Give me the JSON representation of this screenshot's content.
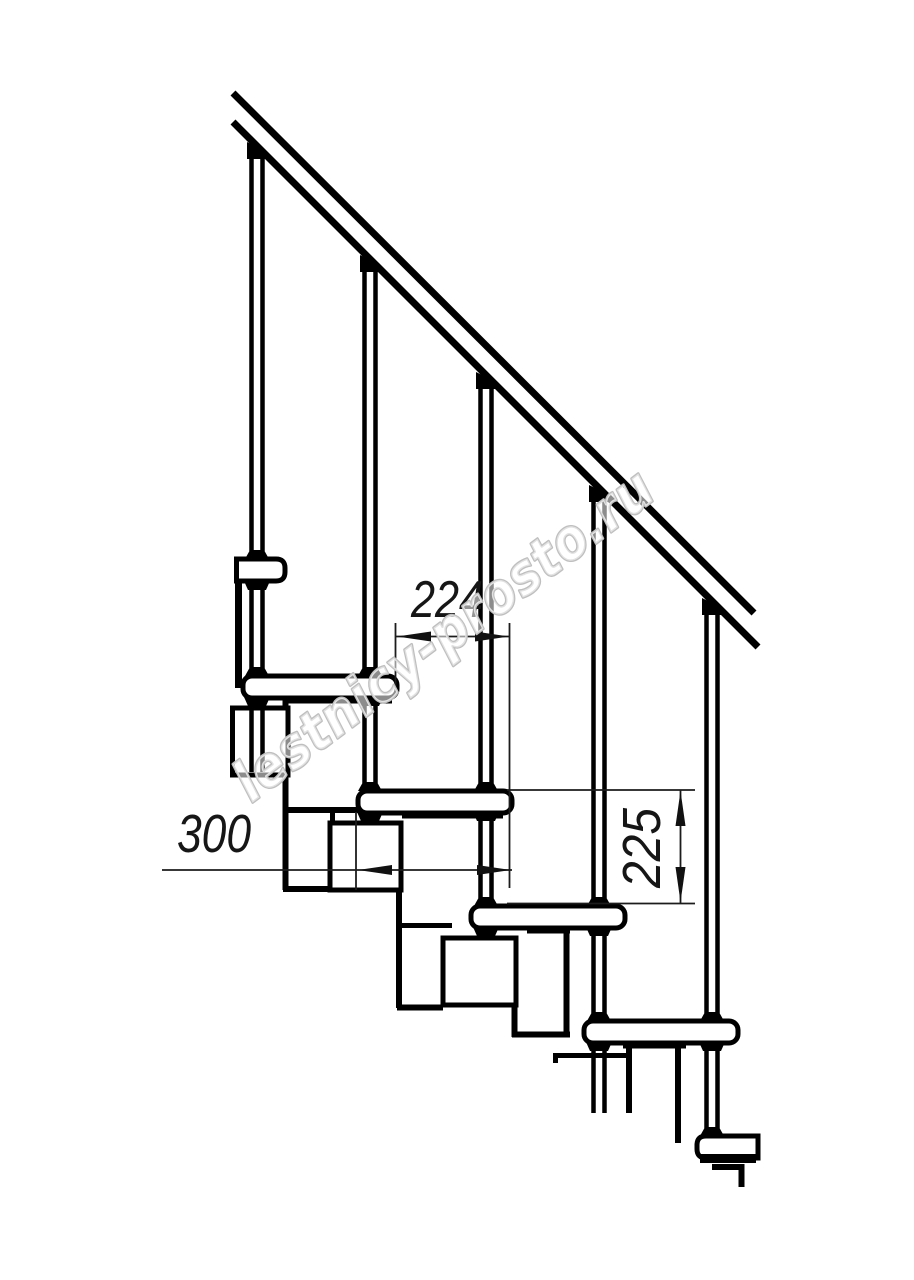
{
  "drawing": {
    "dimension_labels": {
      "run_224": "224",
      "depth_300": "300",
      "rise_225": "225"
    },
    "watermark_text": "lestnicy-prosto.ru",
    "colors": {
      "background": "#ffffff",
      "line": "#000000",
      "dimension_line": "#1c1c1c",
      "watermark_outline": "#bfbfbf",
      "watermark_fill": "rgba(255,255,255,0.55)"
    }
  }
}
